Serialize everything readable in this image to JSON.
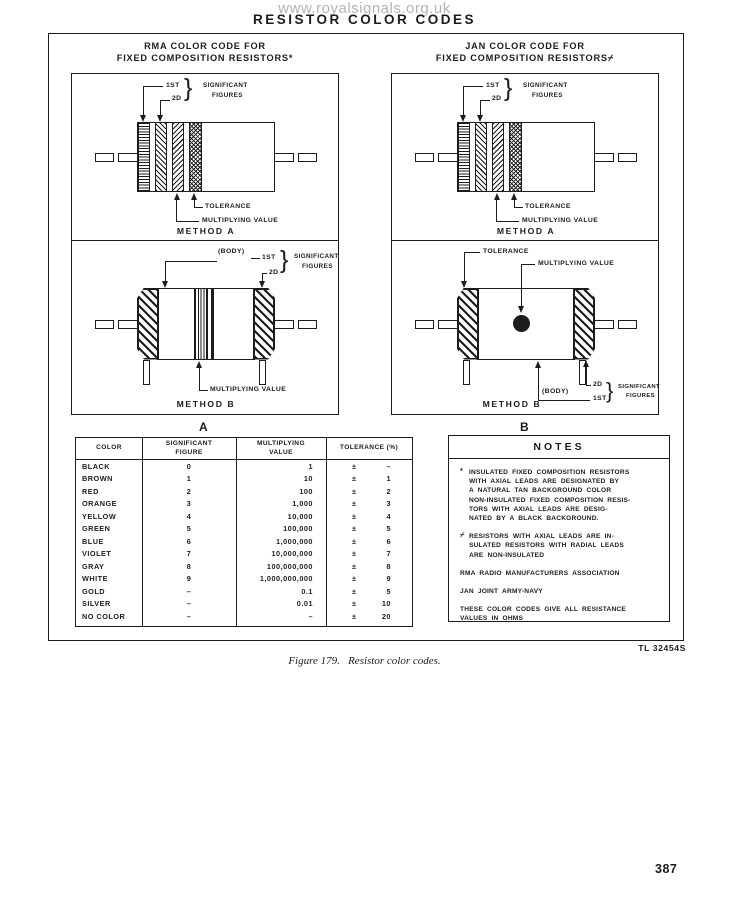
{
  "watermark": "www.royalsignals.org.uk",
  "page_title": "RESISTOR COLOR CODES",
  "panels": {
    "rma": {
      "title_line1": "RMA COLOR CODE FOR",
      "title_line2": "FIXED COMPOSITION RESISTORS*",
      "label": "A"
    },
    "jan": {
      "title_line1": "JAN COLOR CODE FOR",
      "title_line2": "FIXED COMPOSITION RESISTORS⌿",
      "label": "B"
    }
  },
  "diagram_labels": {
    "first": "1ST",
    "second": "2D",
    "significant": "SIGNIFICANT",
    "figures": "FIGURES",
    "tolerance": "TOLERANCE",
    "multiplying": "MULTIPLYING VALUE",
    "body": "(BODY)",
    "method_a": "METHOD A",
    "method_b": "METHOD B",
    "brace": "}"
  },
  "table": {
    "headers": {
      "color": "COLOR",
      "fig1": "SIGNIFICANT",
      "fig2": "FIGURE",
      "mul1": "MULTIPLYING",
      "mul2": "VALUE",
      "tol": "TOLERANCE (%)"
    },
    "rows": [
      {
        "color": "BLACK",
        "figure": "0",
        "multiplier": "1",
        "tol_sign": "±",
        "tolerance": "–"
      },
      {
        "color": "BROWN",
        "figure": "1",
        "multiplier": "10",
        "tol_sign": "±",
        "tolerance": "1"
      },
      {
        "color": "RED",
        "figure": "2",
        "multiplier": "100",
        "tol_sign": "±",
        "tolerance": "2"
      },
      {
        "color": "ORANGE",
        "figure": "3",
        "multiplier": "1,000",
        "tol_sign": "±",
        "tolerance": "3"
      },
      {
        "color": "YELLOW",
        "figure": "4",
        "multiplier": "10,000",
        "tol_sign": "±",
        "tolerance": "4"
      },
      {
        "color": "GREEN",
        "figure": "5",
        "multiplier": "100,000",
        "tol_sign": "±",
        "tolerance": "5"
      },
      {
        "color": "BLUE",
        "figure": "6",
        "multiplier": "1,000,000",
        "tol_sign": "±",
        "tolerance": "6"
      },
      {
        "color": "VIOLET",
        "figure": "7",
        "multiplier": "10,000,000",
        "tol_sign": "±",
        "tolerance": "7"
      },
      {
        "color": "GRAY",
        "figure": "8",
        "multiplier": "100,000,000",
        "tol_sign": "±",
        "tolerance": "8"
      },
      {
        "color": "WHITE",
        "figure": "9",
        "multiplier": "1,000,000,000",
        "tol_sign": "±",
        "tolerance": "9"
      },
      {
        "color": "GOLD",
        "figure": "–",
        "multiplier": "0.1",
        "tol_sign": "±",
        "tolerance": "5"
      },
      {
        "color": "SILVER",
        "figure": "–",
        "multiplier": "0.01",
        "tol_sign": "±",
        "tolerance": "10"
      },
      {
        "color": "NO COLOR",
        "figure": "–",
        "multiplier": "–",
        "tol_sign": "±",
        "tolerance": "20"
      }
    ]
  },
  "notes": {
    "title": "NOTES",
    "items": [
      {
        "marker": "*",
        "lines": [
          "INSULATED FIXED COMPOSITION RESISTORS",
          "WITH AXIAL LEADS ARE DESIGNATED BY",
          "A NATURAL TAN BACKGROUND COLOR",
          "NON-INSULATED FIXED COMPOSITION RESIS-",
          "TORS WITH AXIAL LEADS ARE DESIG-",
          "NATED BY A BLACK BACKGROUND."
        ]
      },
      {
        "marker": "⌿",
        "lines": [
          "RESISTORS WITH AXIAL LEADS ARE IN-",
          "SULATED  RESISTORS WITH RADIAL LEADS",
          "ARE NON-INSULATED"
        ]
      },
      {
        "marker": "",
        "lines": [
          "RMA  RADIO  MANUFACTURERS  ASSOCIATION"
        ]
      },
      {
        "marker": "",
        "lines": [
          "JAN  JOINT  ARMY-NAVY"
        ]
      },
      {
        "marker": "",
        "lines": [
          "THESE COLOR CODES GIVE ALL RESISTANCE",
          "VALUES IN OHMS"
        ]
      }
    ]
  },
  "tl_number": "TL 32454S",
  "figure_caption": "Figure 179.   Resistor color codes.",
  "page_number": "387"
}
